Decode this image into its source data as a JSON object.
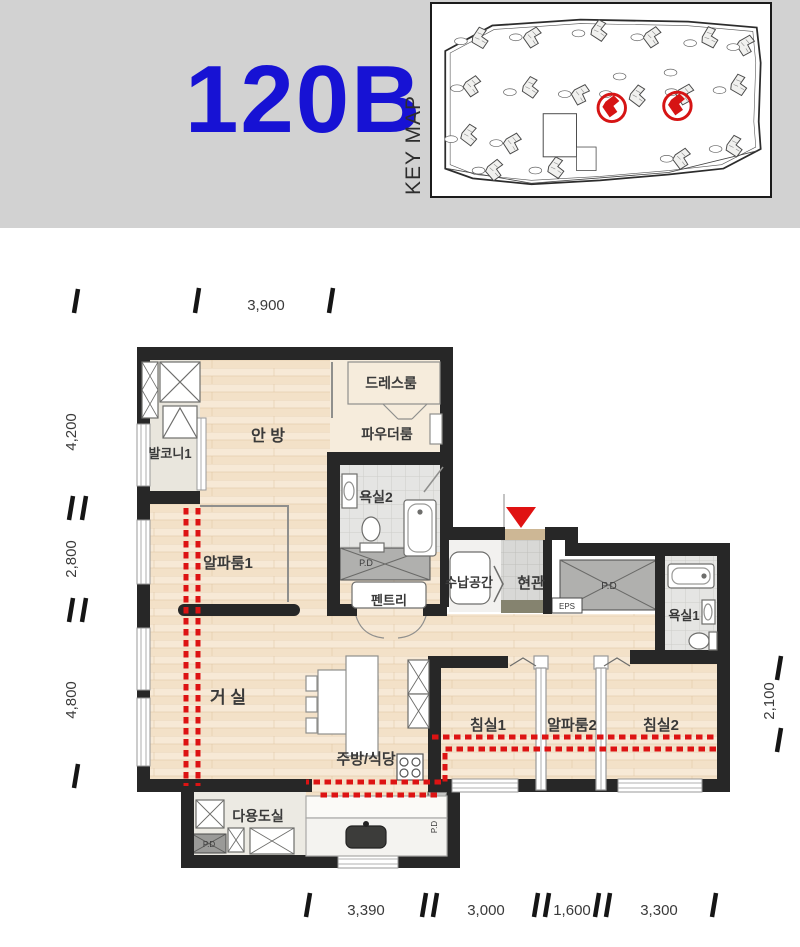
{
  "header": {
    "title": "120B",
    "keymap_label": "KEY MAP"
  },
  "colors": {
    "title_blue": "#1712d4",
    "wall": "#272727",
    "wood": "#f3e1c8",
    "red_accent": "#dd1313",
    "header_bg": "#d2d2d2"
  },
  "plan": {
    "rooms": {
      "master": "안 방",
      "dressroom": "드레스룸",
      "powder": "파우더룸",
      "balcony1": "발코니1",
      "alpha1": "알파룸1",
      "bath2": "욕실2",
      "storage": "수납공간",
      "entry": "현관",
      "pantry": "펜트리",
      "bath1": "욕실1",
      "living": "거 실",
      "kitchen": "주방/식당",
      "utility": "다용도실",
      "bed1": "침실1",
      "alpha2": "알파룸2",
      "bed2": "침실2"
    },
    "labels": {
      "pd": "P.D",
      "eps": "EPS"
    },
    "dimensions": {
      "top": "3,900",
      "left_upper": "4,200",
      "left_middle": "2,800",
      "left_lower": "4,800",
      "right": "2,100",
      "bottom_1": "3,390",
      "bottom_2": "3,000",
      "bottom_3": "1,600",
      "bottom_4": "3,300"
    }
  }
}
